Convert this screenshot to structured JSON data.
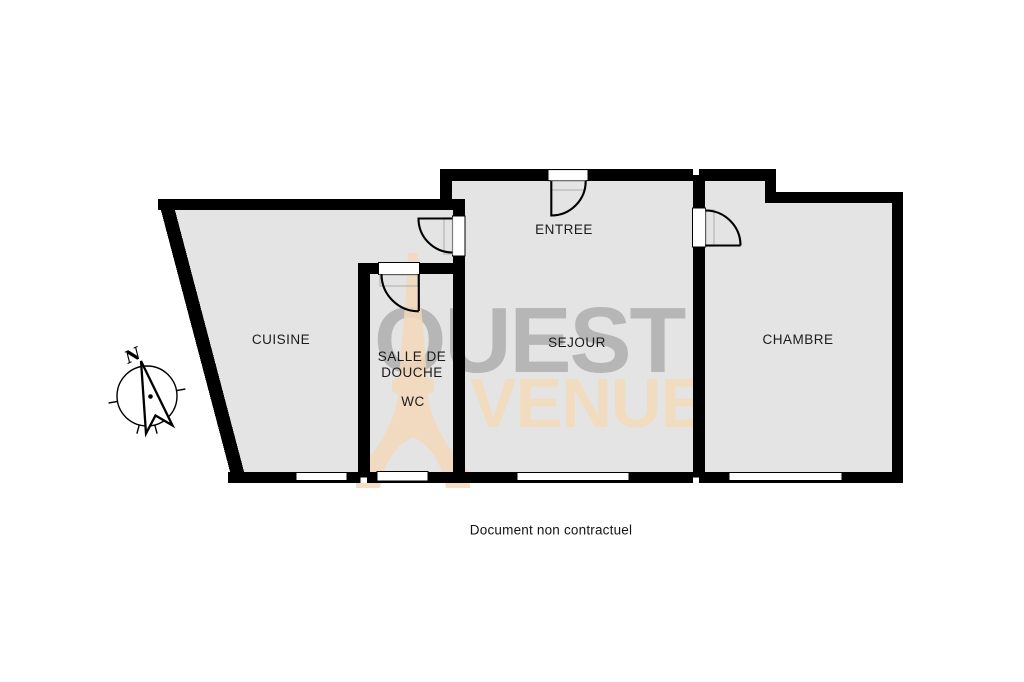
{
  "floorplan": {
    "rooms": {
      "cuisine": {
        "label": "CUISINE"
      },
      "salle_de_douche": {
        "label": "SALLE DE\nDOUCHE"
      },
      "wc": {
        "label": "WC"
      },
      "entree": {
        "label": "ENTREE"
      },
      "sejour": {
        "label": "SEJOUR"
      },
      "chambre": {
        "label": "CHAMBRE"
      }
    },
    "compass": {
      "north_label": "N"
    },
    "colors": {
      "wall": "#000000",
      "floor": "#e4e4e4",
      "watermark_text": "#b6b6b6",
      "watermark_accent": "#f3d8b8"
    }
  },
  "watermark": {
    "brand_line1": "OUEST",
    "brand_line2": "AVENUE",
    "brand_line2_rendered": "VENUE",
    "eiffel_icon": "eiffel-tower"
  },
  "footer": {
    "disclaimer": "Document non contractuel"
  }
}
